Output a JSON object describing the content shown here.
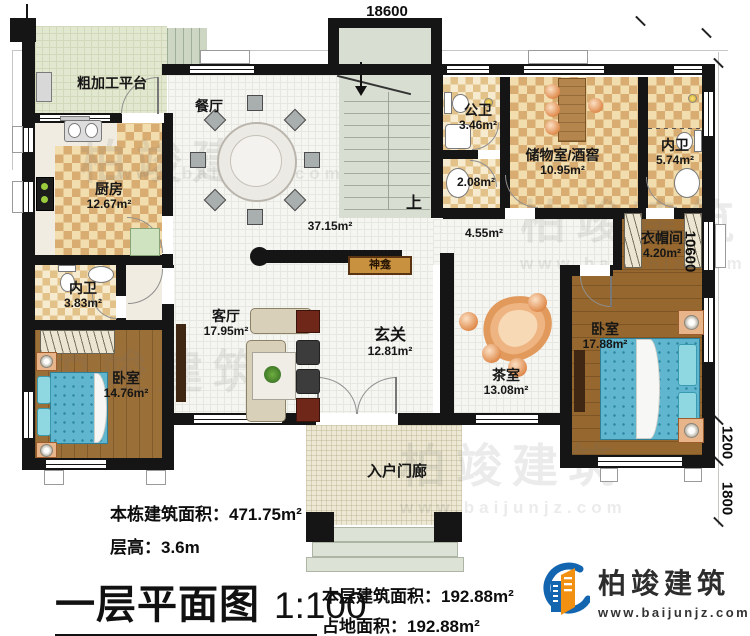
{
  "dims": {
    "top": "18600",
    "right_main": "10600",
    "right_upper": "1200",
    "right_lower": "1800"
  },
  "stairs": {
    "up_label": "上"
  },
  "rooms": {
    "platform": {
      "name": "粗加工平台"
    },
    "kitchen": {
      "name": "厨房",
      "area": "12.67m²"
    },
    "dining": {
      "name": "餐厅"
    },
    "open_area": {
      "area": "37.15m²"
    },
    "corridor": {
      "area": "4.55m²"
    },
    "public_bath": {
      "name": "公卫",
      "area": "3.46m²"
    },
    "wash": {
      "area": "2.08m²"
    },
    "storage": {
      "name": "储物室/酒窖",
      "area": "10.95m²"
    },
    "bath_right": {
      "name": "内卫",
      "area": "5.74m²"
    },
    "cloak": {
      "name": "衣帽间",
      "area": "4.20m²"
    },
    "bedroom_right": {
      "name": "卧室",
      "area": "17.88m²"
    },
    "hall": {
      "name": "玄关",
      "area": "12.81m²"
    },
    "living": {
      "name": "客厅",
      "area": "17.95m²"
    },
    "bath_left": {
      "name": "内卫",
      "area": "3.83m²"
    },
    "bedroom_left": {
      "name": "卧室",
      "area": "14.76m²"
    },
    "tea": {
      "name": "茶室",
      "area": "13.08m²"
    },
    "porch": {
      "name": "入户门廊"
    },
    "shrine": {
      "name": "神龛"
    }
  },
  "footer": {
    "stat1_label": "本栋建筑面积：",
    "stat1_value": "471.75m²",
    "stat2_label": "层高：",
    "stat2_value": "3.6m",
    "title": "一层平面图",
    "scale": "1:100",
    "stat3_label": "本层建筑面积：",
    "stat3_value": "192.88m²",
    "stat4_label": "占地面积：",
    "stat4_value": "192.88m²"
  },
  "branding": {
    "company": "柏竣建筑",
    "website": "www.baijunjz.com"
  },
  "watermark": {
    "text": "柏竣建筑",
    "url": "www.baijunjz.com"
  },
  "colors": {
    "wall": "#151515",
    "brand_blue": "#1465b0",
    "brand_orange": "#f29111",
    "wood": "#9b6f38",
    "bed_blue": "#5fb6ce"
  }
}
